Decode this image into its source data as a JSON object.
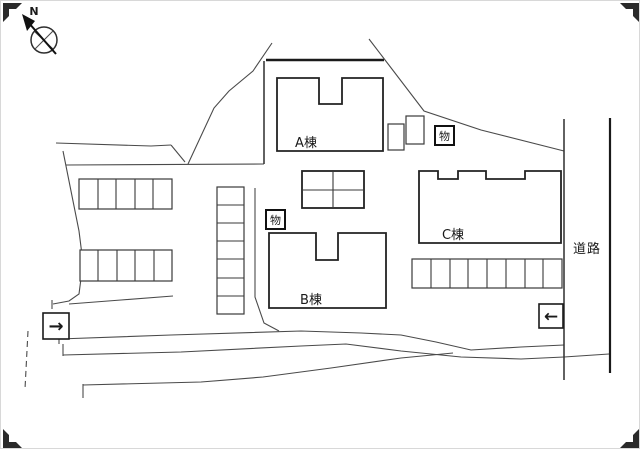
{
  "canvas": {
    "background": "#ffffff",
    "line_color": "#3a3a3a",
    "building_line_color": "#222222"
  },
  "compass": {
    "north_label": "N"
  },
  "buildings": {
    "a": {
      "label": "A棟"
    },
    "b": {
      "label": "B棟"
    },
    "c": {
      "label": "C棟"
    }
  },
  "road": {
    "label": "道路"
  },
  "storage_boxes": {
    "near_a": {
      "label": "物"
    },
    "near_b": {
      "label": "物"
    }
  },
  "arrows": {
    "entry_right": {
      "glyph": "→"
    },
    "entry_left": {
      "glyph": "←"
    }
  },
  "parking": {
    "left_top_row": {
      "cells": 5
    },
    "left_bottom_row": {
      "cells": 5
    },
    "center_column": {
      "cells": 7
    },
    "right_bottom_row": {
      "cells": 8
    },
    "center_grid": {
      "rows": 2,
      "cols": 2
    }
  }
}
